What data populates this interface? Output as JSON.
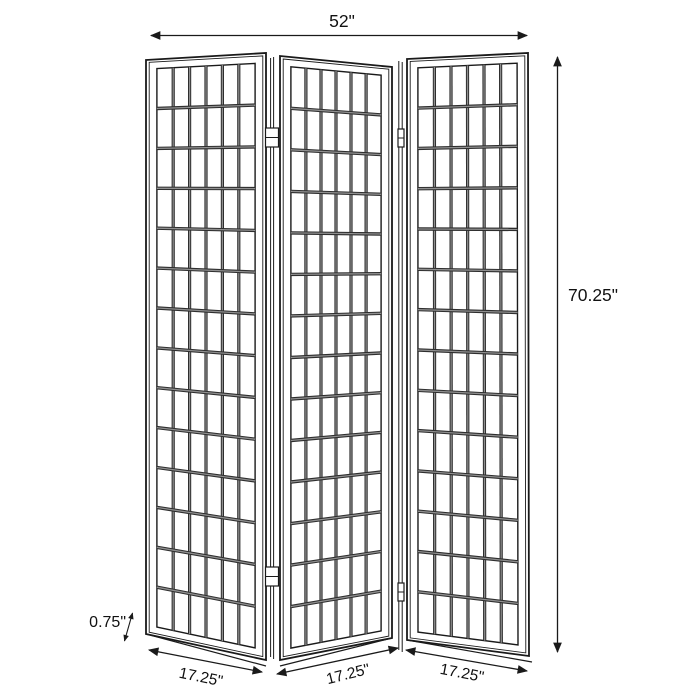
{
  "diagram": {
    "type": "product-dimension-line-drawing",
    "subject": "three-panel-folding-screen",
    "dimensions": {
      "overall_width": "52\"",
      "overall_height": "70.25\"",
      "panel_widths": [
        "17.25\"",
        "17.25\"",
        "17.25\""
      ],
      "panel_thickness": "0.75\""
    },
    "panel_grid": {
      "panel_count": 3,
      "columns": 6,
      "rows": 14,
      "hinges_per_junction": 2
    },
    "colors": {
      "line": "#1a1a1a",
      "grid_bar_dark": "#2e2e2e",
      "grid_bar_light": "#8f8f8f",
      "text": "#111111",
      "background": "#ffffff"
    }
  }
}
